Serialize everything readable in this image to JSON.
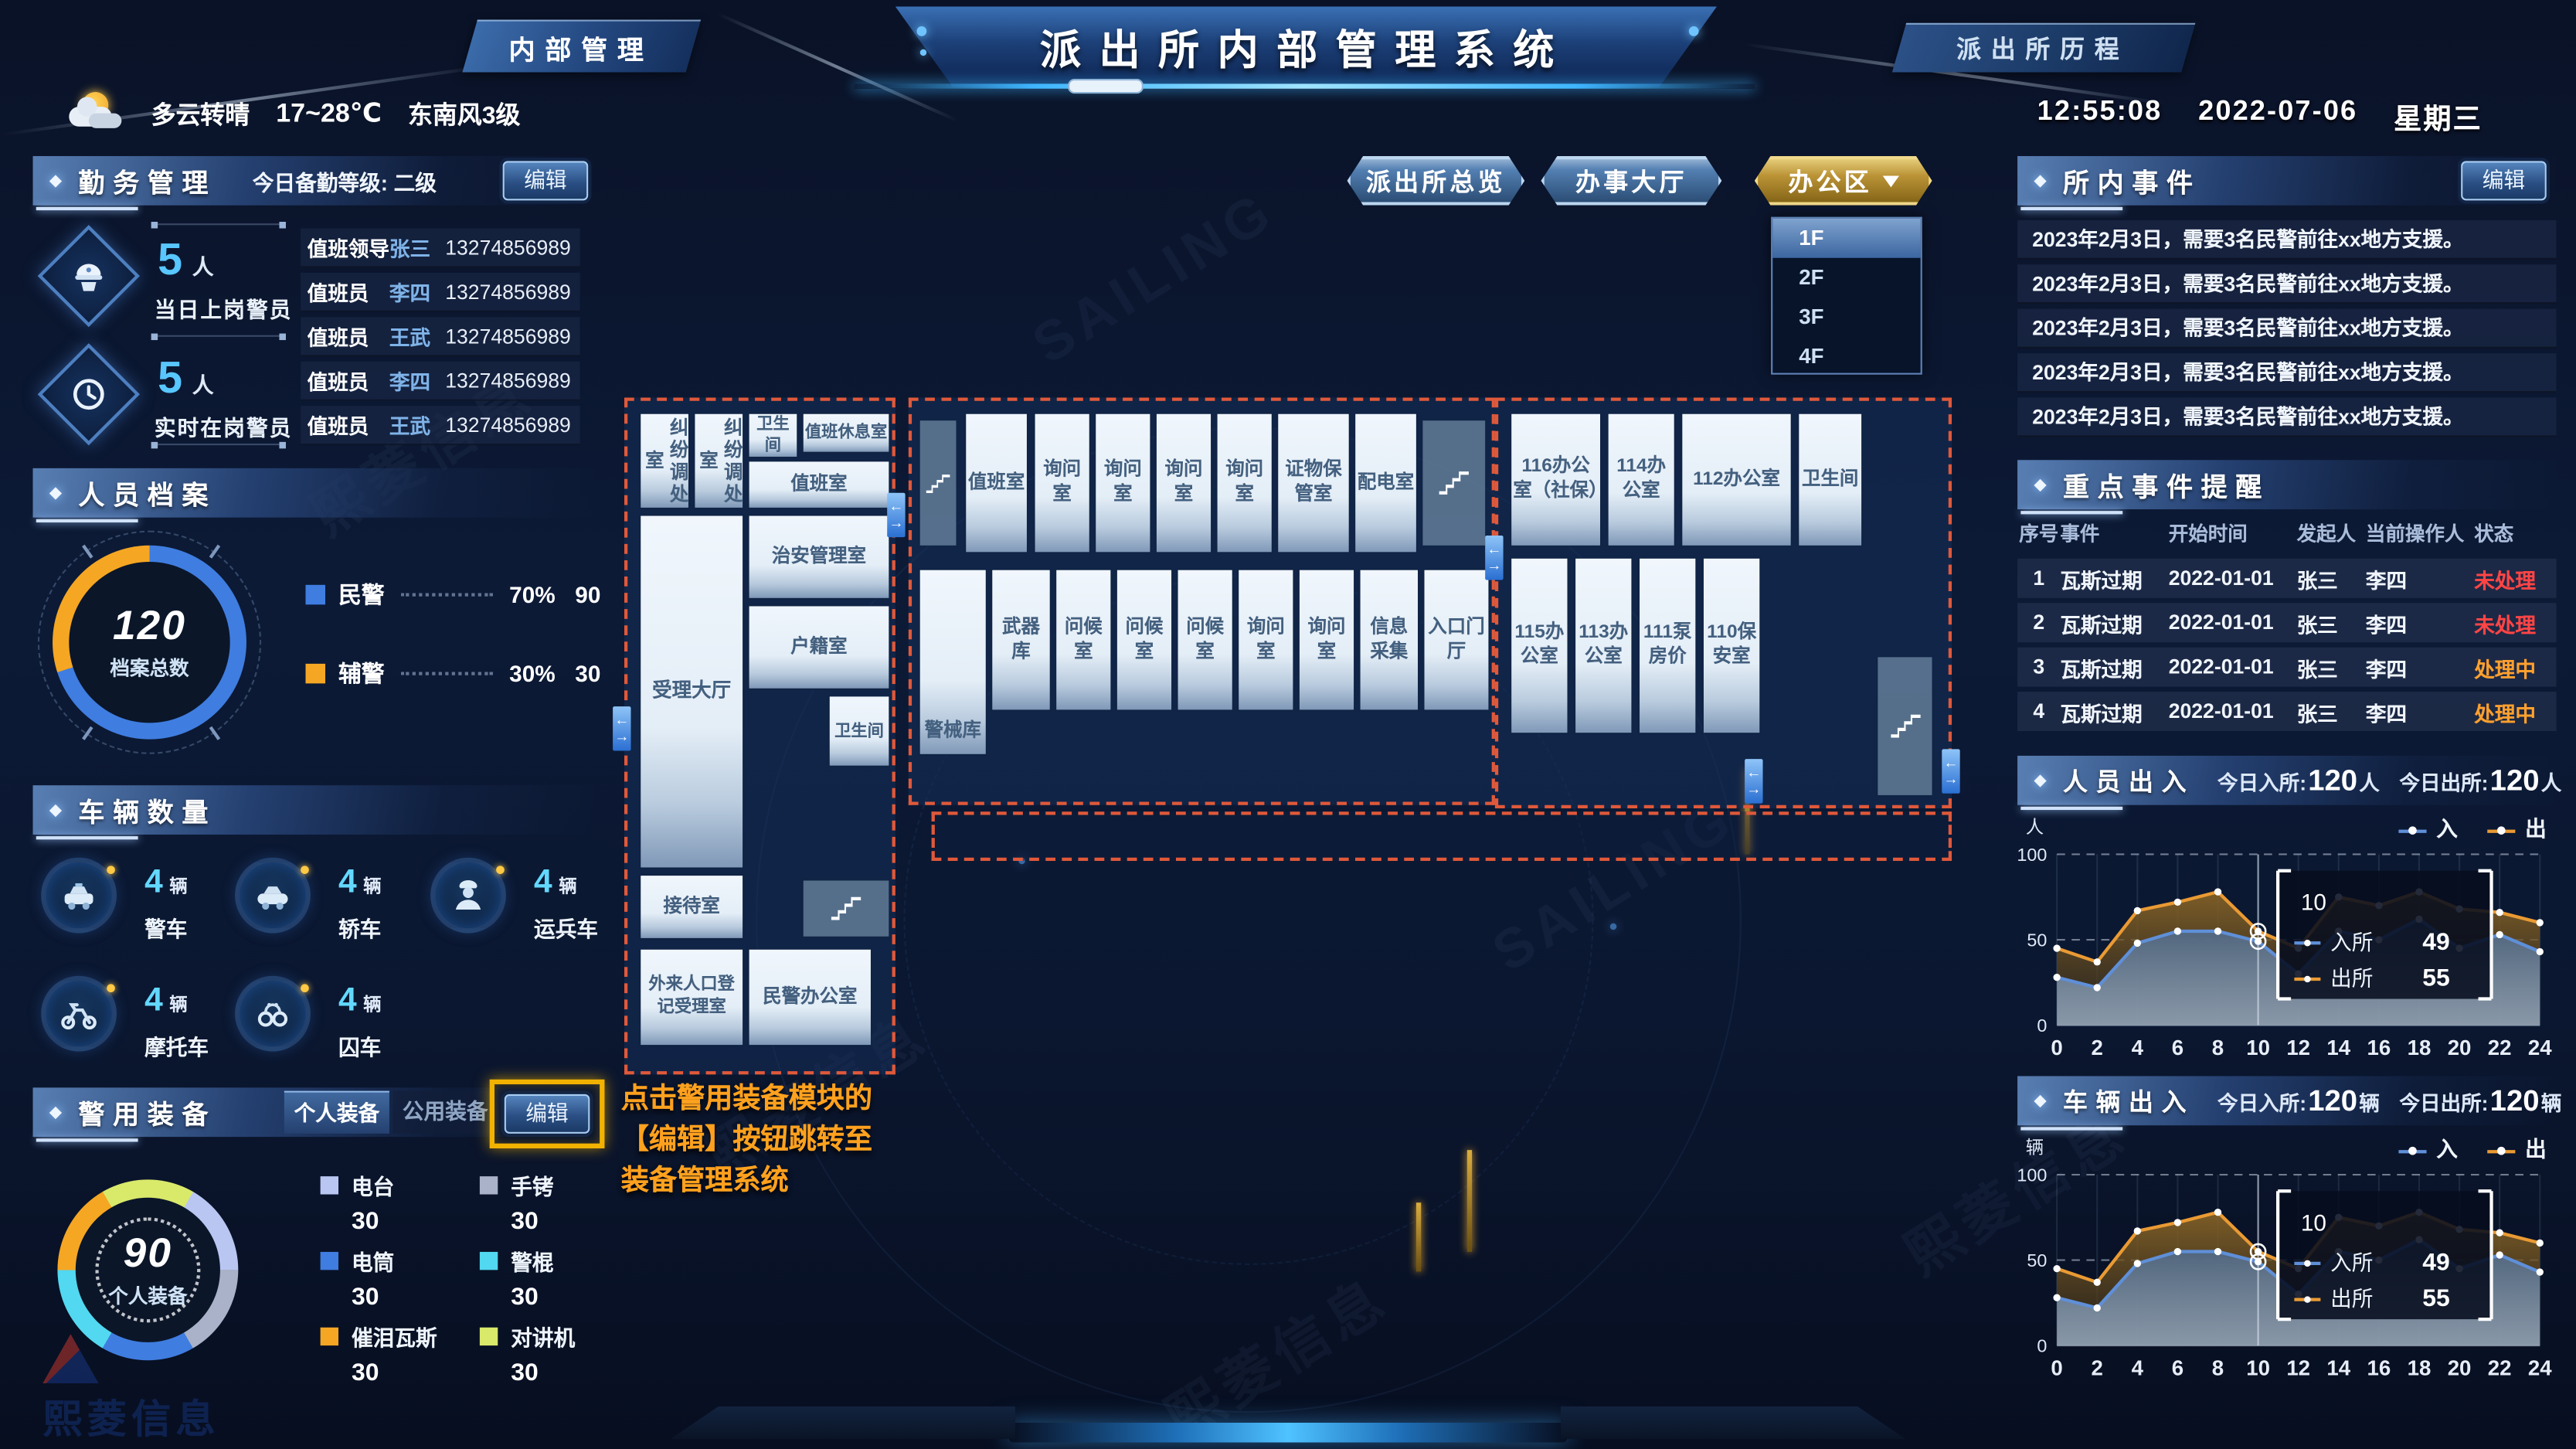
{
  "header": {
    "left_tag": "内部管理",
    "title": "派出所内部管理系统",
    "right_tag": "派出所历程"
  },
  "weather": {
    "condition": "多云转晴",
    "temp": "17~28℃",
    "wind": "东南风3级"
  },
  "clock": {
    "time": "12:55:08",
    "date": "2022-07-06",
    "weekday": "星期三"
  },
  "duty": {
    "title": "勤务管理",
    "level_label": "今日备勤等级: 二级",
    "edit_label": "编辑",
    "groups": [
      {
        "count": "5",
        "unit": "人",
        "caption": "当日上岗警员"
      },
      {
        "count": "5",
        "unit": "人",
        "caption": "实时在岗警员"
      }
    ],
    "roster": [
      {
        "role": "值班领导",
        "name": "张三",
        "phone": "13274856989"
      },
      {
        "role": "值班员",
        "name": "李四",
        "phone": "13274856989"
      },
      {
        "role": "值班员",
        "name": "王武",
        "phone": "13274856989"
      },
      {
        "role": "值班员",
        "name": "李四",
        "phone": "13274856989"
      },
      {
        "role": "值班员",
        "name": "王武",
        "phone": "13274856989"
      }
    ]
  },
  "archives": {
    "title": "人员档案",
    "total": "120",
    "total_label": "档案总数",
    "legend": [
      {
        "label": "民警",
        "percent": "70%",
        "value": "90",
        "color": "#3f7de0"
      },
      {
        "label": "辅警",
        "percent": "30%",
        "value": "30",
        "color": "#f5a623"
      }
    ]
  },
  "vehicles": {
    "title": "车辆数量",
    "items": [
      {
        "name": "警车",
        "count": "4",
        "unit": "辆",
        "icon": "police-car-icon"
      },
      {
        "name": "轿车",
        "count": "4",
        "unit": "辆",
        "icon": "car-icon"
      },
      {
        "name": "运兵车",
        "count": "4",
        "unit": "辆",
        "icon": "officer-icon"
      },
      {
        "name": "摩托车",
        "count": "4",
        "unit": "辆",
        "icon": "motorcycle-icon"
      },
      {
        "name": "囚车",
        "count": "4",
        "unit": "辆",
        "icon": "handcuffs-icon"
      }
    ]
  },
  "equipment": {
    "title": "警用装备",
    "tabs": [
      "个人装备",
      "公用装备"
    ],
    "active_tab": "个人装备",
    "edit_label": "编辑",
    "total": "90",
    "total_label": "个人装备",
    "legend": [
      {
        "label": "电台",
        "value": "30",
        "color": "#b9c6f2"
      },
      {
        "label": "手铐",
        "value": "30",
        "color": "#a9b2c8"
      },
      {
        "label": "电筒",
        "value": "30",
        "color": "#3f7de0"
      },
      {
        "label": "警棍",
        "value": "30",
        "color": "#52d8f0"
      },
      {
        "label": "催泪瓦斯",
        "value": "30",
        "color": "#f5a623"
      },
      {
        "label": "对讲机",
        "value": "30",
        "color": "#d9e96a"
      }
    ]
  },
  "map_tabs": [
    {
      "label": "派出所总览",
      "style": "blue"
    },
    {
      "label": "办事大厅",
      "style": "blue"
    },
    {
      "label": "办公区",
      "style": "gold",
      "has_dropdown": true
    }
  ],
  "floor_dropdown": {
    "options": [
      "1F",
      "2F",
      "3F",
      "4F"
    ],
    "active": "1F"
  },
  "floorplan": {
    "rooms": [
      "纠纷调处室",
      "纠纷调处室",
      "卫生间",
      "值班休息室",
      "值班室",
      "受理大厅",
      "治安管理室",
      "户籍室",
      "卫生间",
      "接待室",
      "外来人口登记受理室",
      "民警办公室",
      "值班室",
      "询问室",
      "询问室",
      "询问室",
      "询问室",
      "证物保管室",
      "配电室",
      "警械库",
      "武器库",
      "问候室",
      "问候室",
      "问候室",
      "询问室",
      "询问室",
      "信息采集",
      "入口门厅",
      "116办公室（社保）",
      "114办公室",
      "112办公室",
      "卫生间",
      "115办公室",
      "113办公室",
      "111泵房价",
      "110保安室"
    ]
  },
  "annotation": {
    "lines": [
      "点击警用装备模块的",
      "【编辑】按钮跳转至",
      "装备管理系统"
    ]
  },
  "events": {
    "title": "所内事件",
    "edit_label": "编辑",
    "items": [
      "2023年2月3日，需要3名民警前往xx地方支援。",
      "2023年2月3日，需要3名民警前往xx地方支援。",
      "2023年2月3日，需要3名民警前往xx地方支援。",
      "2023年2月3日，需要3名民警前往xx地方支援。",
      "2023年2月3日，需要3名民警前往xx地方支援。"
    ]
  },
  "key_events": {
    "title": "重点事件提醒",
    "columns": [
      "序号",
      "事件",
      "开始时间",
      "发起人",
      "当前操作人",
      "状态"
    ],
    "rows": [
      {
        "no": "1",
        "event": "瓦斯过期",
        "start": "2022-01-01",
        "initiator": "张三",
        "operator": "李四",
        "status": "未处理",
        "status_color": "#ff4545"
      },
      {
        "no": "2",
        "event": "瓦斯过期",
        "start": "2022-01-01",
        "initiator": "张三",
        "operator": "李四",
        "status": "未处理",
        "status_color": "#ff4545"
      },
      {
        "no": "3",
        "event": "瓦斯过期",
        "start": "2022-01-01",
        "initiator": "张三",
        "operator": "李四",
        "status": "处理中",
        "status_color": "#ffa02e"
      },
      {
        "no": "4",
        "event": "瓦斯过期",
        "start": "2022-01-01",
        "initiator": "张三",
        "operator": "李四",
        "status": "处理中",
        "status_color": "#ffa02e"
      }
    ]
  },
  "chart_data": [
    {
      "type": "area",
      "title": "人员出入",
      "unit": "人",
      "stats": {
        "in_label": "今日入所:",
        "in_value": "120",
        "in_unit": "人",
        "out_label": "今日出所:",
        "out_value": "120",
        "out_unit": "人"
      },
      "x": [
        0,
        2,
        4,
        6,
        8,
        10,
        12,
        14,
        16,
        18,
        20,
        22,
        24
      ],
      "ylim": [
        0,
        100
      ],
      "yticks": [
        0,
        50,
        100
      ],
      "legend_position": "top-right",
      "grid": "dashed-horizontal",
      "series": [
        {
          "name": "入",
          "color": "#5f8fd8",
          "values": [
            28,
            22,
            48,
            55,
            55,
            49,
            30,
            55,
            50,
            62,
            45,
            53,
            43
          ]
        },
        {
          "name": "出",
          "color": "#ea9a33",
          "values": [
            45,
            37,
            67,
            72,
            78,
            55,
            45,
            75,
            70,
            78,
            68,
            66,
            60
          ]
        }
      ],
      "tooltip": {
        "x": 10,
        "rows": [
          {
            "label": "入所",
            "value": 49,
            "color": "#5f8fd8"
          },
          {
            "label": "出所",
            "value": 55,
            "color": "#ea9a33"
          }
        ]
      }
    },
    {
      "type": "area",
      "title": "车辆出入",
      "unit": "辆",
      "stats": {
        "in_label": "今日入所:",
        "in_value": "120",
        "in_unit": "辆",
        "out_label": "今日出所:",
        "out_value": "120",
        "out_unit": "辆"
      },
      "x": [
        0,
        2,
        4,
        6,
        8,
        10,
        12,
        14,
        16,
        18,
        20,
        22,
        24
      ],
      "ylim": [
        0,
        100
      ],
      "yticks": [
        0,
        50,
        100
      ],
      "legend_position": "top-right",
      "grid": "dashed-horizontal",
      "series": [
        {
          "name": "入",
          "color": "#5f8fd8",
          "values": [
            28,
            22,
            48,
            55,
            55,
            49,
            30,
            55,
            50,
            62,
            45,
            53,
            43
          ]
        },
        {
          "name": "出",
          "color": "#ea9a33",
          "values": [
            45,
            37,
            67,
            72,
            78,
            55,
            45,
            75,
            70,
            78,
            68,
            66,
            60
          ]
        }
      ],
      "tooltip": {
        "x": 10,
        "rows": [
          {
            "label": "入所",
            "value": 49,
            "color": "#5f8fd8"
          },
          {
            "label": "出所",
            "value": 55,
            "color": "#ea9a33"
          }
        ]
      }
    }
  ],
  "watermark": {
    "latin": "SAILING",
    "brand": "熙菱信息"
  }
}
